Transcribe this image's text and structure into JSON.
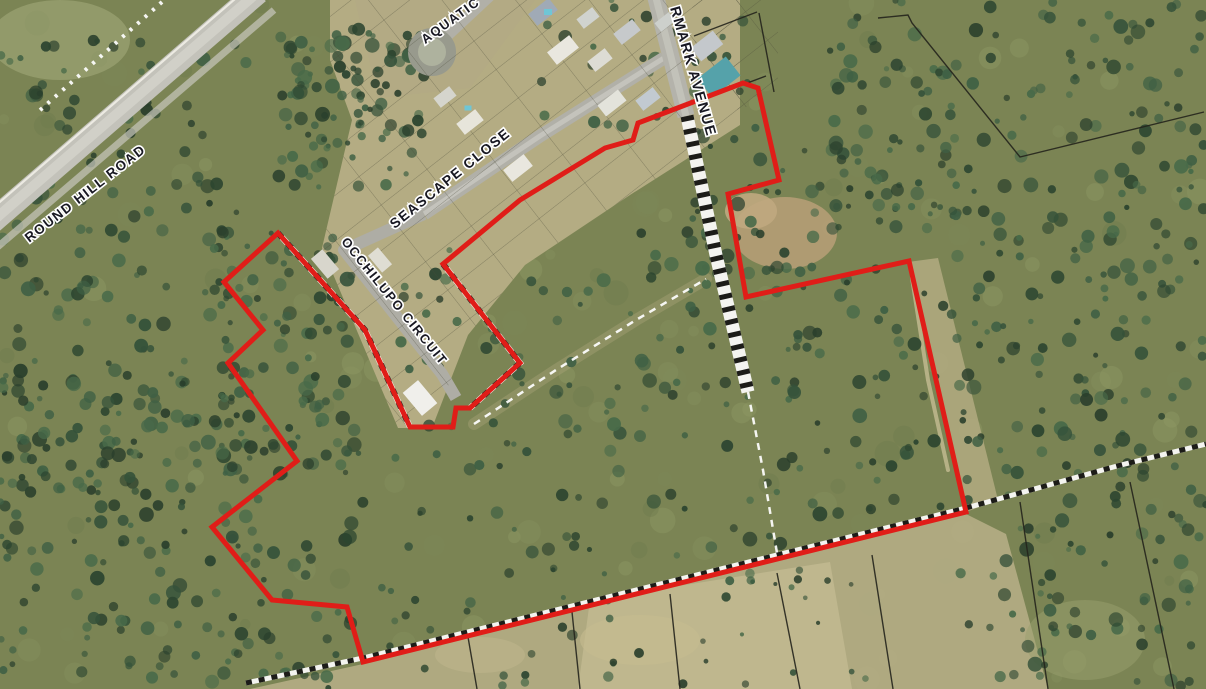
{
  "map": {
    "title": "aerial-cadastral-map",
    "background_color": "#7b8454",
    "labels": [
      {
        "id": "round-hill-road",
        "text": "ROUND HILL ROAD",
        "x": 88,
        "y": 197,
        "rotation": -38,
        "size": 13.5,
        "anchor": "middle"
      },
      {
        "id": "aquatic",
        "text": "AQUATIC",
        "x": 453,
        "y": 24,
        "rotation": -36,
        "size": 13,
        "anchor": "middle"
      },
      {
        "id": "seascape-close",
        "text": "SEASCAPE CLOSE",
        "x": 453,
        "y": 182,
        "rotation": -39,
        "size": 14,
        "anchor": "middle"
      },
      {
        "id": "occhilupo-circuit",
        "text": "OCCHILUPO CIRCUIT",
        "x": 391,
        "y": 304,
        "rotation": 51,
        "size": 13,
        "anchor": "middle"
      },
      {
        "id": "rmark-avenue",
        "text": "RMARK AVENUE",
        "x": 670,
        "y": 8,
        "rotation": 74,
        "size": 14.5,
        "anchor": "start"
      }
    ],
    "boundary": {
      "color": "#e01d18",
      "stroke_width": 5,
      "points": [
        [
          278,
          233
        ],
        [
          365,
          330
        ],
        [
          410,
          427
        ],
        [
          453,
          427
        ],
        [
          456,
          408
        ],
        [
          470,
          408
        ],
        [
          520,
          363
        ],
        [
          443,
          264
        ],
        [
          520,
          200
        ],
        [
          605,
          148
        ],
        [
          633,
          140
        ],
        [
          638,
          123
        ],
        [
          743,
          83
        ],
        [
          758,
          88
        ],
        [
          779,
          180
        ],
        [
          728,
          194
        ],
        [
          746,
          297
        ],
        [
          909,
          261
        ],
        [
          966,
          512
        ],
        [
          363,
          662
        ],
        [
          347,
          607
        ],
        [
          272,
          600
        ],
        [
          212,
          527
        ],
        [
          297,
          461
        ],
        [
          228,
          363
        ],
        [
          263,
          330
        ],
        [
          224,
          282
        ]
      ]
    },
    "roads": [
      {
        "id": "round-hill-road-band",
        "path": [
          [
            258,
            -8
          ],
          [
            -20,
            232
          ]
        ],
        "w": 24,
        "c": "#c3c2ba"
      },
      {
        "id": "round-hill-road-centre",
        "path": [
          [
            258,
            -8
          ],
          [
            -20,
            232
          ]
        ],
        "w": 10,
        "c": "#d3d2ca",
        "op": 0.85
      },
      {
        "id": "round-hill-road-edge",
        "path": [
          [
            250,
            -14
          ],
          [
            -28,
            226
          ]
        ],
        "w": 2.2,
        "c": "#eceae2"
      },
      {
        "id": "round-hill-road-verge",
        "path": [
          [
            274,
            10
          ],
          [
            -6,
            250
          ]
        ],
        "w": 7,
        "c": "#c9c7be",
        "op": 0.7
      },
      {
        "id": "seascape-close-band",
        "path": [
          [
            664,
            58
          ],
          [
            540,
            136
          ],
          [
            424,
            214
          ]
        ],
        "w": 13,
        "c": "#b1b0a8"
      },
      {
        "id": "seascape-close-centre",
        "path": [
          [
            664,
            58
          ],
          [
            540,
            136
          ],
          [
            424,
            214
          ]
        ],
        "w": 5,
        "c": "#c9c8c0",
        "op": 0.8
      },
      {
        "id": "occhilupo-circuit-band",
        "path": [
          [
            424,
            214
          ],
          [
            344,
            250
          ],
          [
            442,
            374
          ],
          [
            456,
            398
          ]
        ],
        "w": 12,
        "c": "#aeada5"
      },
      {
        "id": "aquatic-stub",
        "path": [
          [
            447,
            36
          ],
          [
            492,
            -6
          ]
        ],
        "w": 11,
        "c": "#b1b0a8"
      },
      {
        "id": "avenue-band",
        "path": [
          [
            655,
            -6
          ],
          [
            686,
            116
          ]
        ],
        "w": 17,
        "c": "#b4b3ab"
      },
      {
        "id": "avenue-centre",
        "path": [
          [
            655,
            -6
          ],
          [
            686,
            116
          ]
        ],
        "w": 7,
        "c": "#c6c5bd",
        "op": 0.8
      }
    ],
    "culdesac": {
      "cx": 432,
      "cy": 52,
      "r": 19,
      "ring_color": "#989a8d",
      "ring_w": 10,
      "fill": "#aeb29e"
    },
    "hatched_lines": [
      {
        "id": "avenue-unformed-road",
        "pts": [
          [
            687,
            116
          ],
          [
            716,
            255
          ],
          [
            748,
            392
          ]
        ],
        "w": 13,
        "dash": "5 8"
      },
      {
        "id": "south-parcel-hatch",
        "pts": [
          [
            246,
            683
          ],
          [
            363,
            658
          ],
          [
            966,
            508
          ],
          [
            1117,
            466
          ],
          [
            1206,
            444
          ]
        ],
        "w": 5,
        "dash": "6 7"
      },
      {
        "id": "occhilupo-parcel-hatch",
        "pts": [
          [
            278,
            233
          ],
          [
            365,
            330
          ],
          [
            410,
            427
          ]
        ],
        "w": 6,
        "dash": "6 8"
      },
      {
        "id": "estate-edge-hatch",
        "pts": [
          [
            443,
            264
          ],
          [
            520,
            363
          ],
          [
            470,
            408
          ]
        ],
        "w": 6,
        "dash": "6 8"
      }
    ],
    "dashed_tracks": [
      {
        "id": "central-track",
        "pts": [
          [
            474,
            424
          ],
          [
            556,
            370
          ],
          [
            636,
            320
          ],
          [
            706,
            279
          ]
        ],
        "w": 2.5,
        "dash": "7 6"
      },
      {
        "id": "avenue-track-south",
        "pts": [
          [
            748,
            392
          ],
          [
            763,
            470
          ],
          [
            777,
            553
          ]
        ],
        "w": 2.5,
        "dash": "7 6"
      },
      {
        "id": "round-hill-pickets",
        "pts": [
          [
            162,
            2
          ],
          [
            38,
            112
          ]
        ],
        "w": 4,
        "dash": "3 7"
      }
    ],
    "cadastral_lines": [
      [
        [
          878,
          18
        ],
        [
          908,
          15
        ],
        [
          912,
          23
        ],
        [
          1020,
          157
        ],
        [
          1204,
          112
        ]
      ],
      [
        [
          1020,
          502
        ],
        [
          1048,
          689
        ]
      ],
      [
        [
          1130,
          482
        ],
        [
          1174,
          689
        ]
      ],
      [
        [
          777,
          573
        ],
        [
          800,
          689
        ]
      ],
      [
        [
          468,
          637
        ],
        [
          477,
          689
        ]
      ],
      [
        [
          572,
          612
        ],
        [
          580,
          689
        ]
      ],
      [
        [
          670,
          594
        ],
        [
          680,
          689
        ]
      ],
      [
        [
          872,
          555
        ],
        [
          893,
          689
        ]
      ],
      [
        [
          694,
          36
        ],
        [
          757,
          12
        ]
      ],
      [
        [
          702,
          100
        ],
        [
          766,
          76
        ]
      ],
      [
        [
          759,
          13
        ],
        [
          774,
          92
        ]
      ]
    ],
    "roofs": [
      {
        "x": 543,
        "y": 12,
        "w": 26,
        "h": 15,
        "rot": -38,
        "c": "#a0aab6"
      },
      {
        "x": 563,
        "y": 50,
        "w": 28,
        "h": 16,
        "rot": -38,
        "c": "#e9e7df"
      },
      {
        "x": 600,
        "y": 60,
        "w": 22,
        "h": 13,
        "rot": -38,
        "c": "#dddcd4"
      },
      {
        "x": 627,
        "y": 32,
        "w": 24,
        "h": 14,
        "rot": -38,
        "c": "#c6c9cb"
      },
      {
        "x": 588,
        "y": 18,
        "w": 20,
        "h": 12,
        "rot": -38,
        "c": "#d0d3cf"
      },
      {
        "x": 665,
        "y": 22,
        "w": 18,
        "h": 11,
        "rot": -38,
        "c": "#cdd0cc"
      },
      {
        "x": 612,
        "y": 103,
        "w": 26,
        "h": 14,
        "rot": -38,
        "c": "#e3e3db"
      },
      {
        "x": 648,
        "y": 99,
        "w": 22,
        "h": 13,
        "rot": -38,
        "c": "#c2cad1"
      },
      {
        "x": 707,
        "y": 46,
        "w": 28,
        "h": 17,
        "rot": -38,
        "c": "#c4c8cc"
      },
      {
        "x": 719,
        "y": 77,
        "w": 36,
        "h": 24,
        "rot": -38,
        "c": "#55a2aa"
      },
      {
        "x": 470,
        "y": 122,
        "w": 24,
        "h": 14,
        "rot": -38,
        "c": "#e7e5db"
      },
      {
        "x": 445,
        "y": 97,
        "w": 20,
        "h": 12,
        "rot": -38,
        "c": "#d5d5cd"
      },
      {
        "x": 518,
        "y": 168,
        "w": 26,
        "h": 15,
        "rot": -38,
        "c": "#e9e7df"
      },
      {
        "x": 380,
        "y": 260,
        "w": 22,
        "h": 13,
        "rot": 50,
        "c": "#dfddd3"
      },
      {
        "x": 325,
        "y": 264,
        "w": 26,
        "h": 15,
        "rot": 50,
        "c": "#d8d6cc"
      },
      {
        "x": 420,
        "y": 398,
        "w": 30,
        "h": 20,
        "rot": 50,
        "c": "#f0efeb"
      }
    ],
    "pools": [
      {
        "x": 548,
        "y": 12,
        "w": 8,
        "h": 6,
        "c": "#6fc6d6"
      },
      {
        "x": 468,
        "y": 108,
        "w": 7,
        "h": 5,
        "c": "#6fc6d6"
      }
    ],
    "patches": [
      {
        "t": "poly",
        "pts": [
          [
            330,
            0
          ],
          [
            740,
            0
          ],
          [
            740,
            125
          ],
          [
            630,
            195
          ],
          [
            525,
            265
          ],
          [
            468,
            335
          ],
          [
            432,
            428
          ],
          [
            398,
            428
          ],
          [
            322,
            248
          ],
          [
            352,
            120
          ],
          [
            330,
            60
          ]
        ],
        "c": "#b7ae86",
        "op": 0.95
      },
      {
        "t": "poly",
        "pts": [
          [
            355,
            0
          ],
          [
            535,
            0
          ],
          [
            470,
            88
          ],
          [
            378,
            98
          ]
        ],
        "c": "#b3aa84",
        "op": 0.9
      },
      {
        "t": "poly",
        "pts": [
          [
            250,
            689
          ],
          [
            363,
            664
          ],
          [
            966,
            514
          ],
          [
            1006,
            534
          ],
          [
            1048,
            689
          ]
        ],
        "c": "#b5ad85",
        "op": 0.9
      },
      {
        "t": "poly",
        "pts": [
          [
            590,
            600
          ],
          [
            830,
            562
          ],
          [
            852,
            689
          ],
          [
            578,
            689
          ]
        ],
        "c": "#c2ba90",
        "op": 0.85
      },
      {
        "t": "poly",
        "pts": [
          [
            908,
            262
          ],
          [
            966,
            512
          ],
          [
            998,
            500
          ],
          [
            938,
            258
          ]
        ],
        "c": "#b3aa81",
        "op": 0.85
      },
      {
        "t": "ell",
        "cx": 785,
        "cy": 233,
        "rx": 52,
        "ry": 36,
        "c": "#b59d76",
        "op": 0.9
      },
      {
        "t": "ell",
        "cx": 751,
        "cy": 211,
        "rx": 26,
        "ry": 18,
        "c": "#c0a87f",
        "op": 0.9
      },
      {
        "t": "line",
        "pts": [
          [
            474,
            424
          ],
          [
            556,
            370
          ],
          [
            636,
            320
          ],
          [
            706,
            279
          ]
        ],
        "w": 12,
        "c": "#a7a276",
        "op": 0.45
      },
      {
        "t": "line",
        "pts": [
          [
            912,
            278
          ],
          [
            928,
            380
          ],
          [
            948,
            470
          ]
        ],
        "w": 4,
        "c": "#c6bd92",
        "op": 0.8
      },
      {
        "t": "ell",
        "cx": 640,
        "cy": 640,
        "rx": 60,
        "ry": 25,
        "c": "#c6bd90",
        "op": 0.6
      },
      {
        "t": "ell",
        "cx": 480,
        "cy": 655,
        "rx": 45,
        "ry": 18,
        "c": "#bfb68c",
        "op": 0.55
      },
      {
        "t": "ell",
        "cx": 1085,
        "cy": 640,
        "rx": 60,
        "ry": 40,
        "c": "#9aa06e",
        "op": 0.5
      },
      {
        "t": "ell",
        "cx": 60,
        "cy": 40,
        "rx": 70,
        "ry": 40,
        "c": "#aab07f",
        "op": 0.5
      }
    ],
    "tree_regions": [
      {
        "x": 0,
        "y": 40,
        "w": 250,
        "h": 430,
        "n": 150
      },
      {
        "x": 278,
        "y": 28,
        "w": 150,
        "h": 160,
        "n": 110
      },
      {
        "x": 0,
        "y": 380,
        "w": 370,
        "h": 309,
        "n": 200
      },
      {
        "x": 210,
        "y": 230,
        "w": 150,
        "h": 250,
        "n": 90
      },
      {
        "x": 390,
        "y": 230,
        "w": 400,
        "h": 330,
        "n": 120
      },
      {
        "x": 790,
        "y": 140,
        "w": 190,
        "h": 380,
        "n": 85
      },
      {
        "x": 950,
        "y": 0,
        "w": 256,
        "h": 480,
        "n": 190
      },
      {
        "x": 540,
        "y": 0,
        "w": 210,
        "h": 130,
        "n": 30
      },
      {
        "x": 830,
        "y": 0,
        "w": 130,
        "h": 230,
        "n": 60
      },
      {
        "x": 380,
        "y": 560,
        "w": 650,
        "h": 129,
        "n": 55,
        "small": true
      },
      {
        "x": 1000,
        "y": 470,
        "w": 206,
        "h": 219,
        "n": 70
      },
      {
        "x": 690,
        "y": 120,
        "w": 100,
        "h": 180,
        "n": 35
      }
    ],
    "tree_palette": [
      "#2c4530",
      "#35523a",
      "#3f6044",
      "#2a3f2c",
      "#486a49"
    ],
    "speckle_palette": [
      "#87905f",
      "#7d8757",
      "#929a66",
      "#6f7a4e"
    ],
    "grid_clips": {
      "estate": [
        [
          330,
          0
        ],
        [
          740,
          0
        ],
        [
          740,
          125
        ],
        [
          630,
          195
        ],
        [
          525,
          265
        ],
        [
          468,
          335
        ],
        [
          432,
          428
        ],
        [
          398,
          428
        ],
        [
          322,
          248
        ],
        [
          352,
          120
        ],
        [
          330,
          60
        ]
      ],
      "east_of_avenue": [
        [
          692,
          0
        ],
        [
          778,
          0
        ],
        [
          778,
          98
        ],
        [
          700,
          120
        ]
      ]
    }
  }
}
